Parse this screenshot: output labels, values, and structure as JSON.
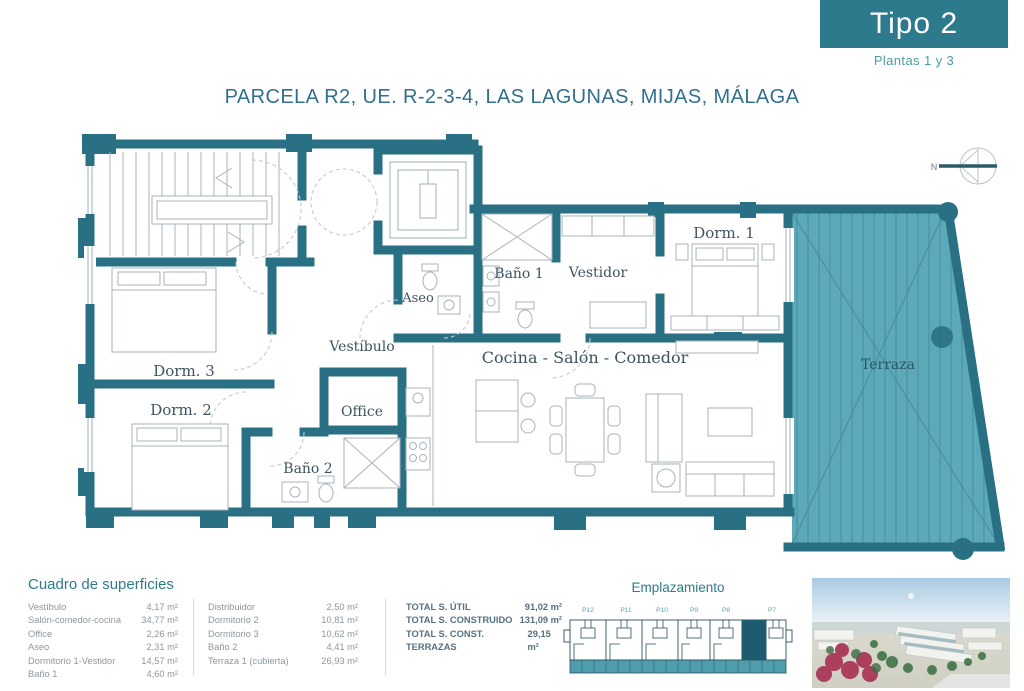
{
  "header": {
    "type_label": "Tipo 2",
    "subtitle": "Plantas 1 y 3"
  },
  "title": "PARCELA R2, UE. R-2-3-4, LAS LAGUNAS, MIJAS, MÁLAGA",
  "plan": {
    "compass": "N",
    "rooms": {
      "dorm1": "Dorm. 1",
      "vestidor": "Vestidor",
      "bano1": "Baño 1",
      "aseo": "Aseo",
      "vestibulo": "Vestíbulo",
      "salon": "Cocina - Salón - Comedor",
      "dorm3": "Dorm. 3",
      "dorm2": "Dorm. 2",
      "office": "Office",
      "bano2": "Baño 2",
      "terraza": "Terraza"
    }
  },
  "surfaces": {
    "heading": "Cuadro de superficies",
    "left": [
      {
        "label": "Vestíbulo",
        "value": "4,17 m²"
      },
      {
        "label": "Salón-comedor-cocina",
        "value": "34,77 m²"
      },
      {
        "label": "Office",
        "value": "2,26 m²"
      },
      {
        "label": "Aseo",
        "value": "2,31 m²"
      },
      {
        "label": "Dormitorio 1-Vestidor",
        "value": "14,57 m²"
      },
      {
        "label": "Baño 1",
        "value": "4,60 m²"
      }
    ],
    "right": [
      {
        "label": "Distribuidor",
        "value": "2,50 m²"
      },
      {
        "label": "Dormitorio 2",
        "value": "10,81 m²"
      },
      {
        "label": "Dormitorio 3",
        "value": "10,62 m²"
      },
      {
        "label": "Baño 2",
        "value": "4,41 m²"
      },
      {
        "label": "Terraza 1 (cubierta)",
        "value": "26,93 m²"
      }
    ],
    "totals": [
      {
        "label": "TOTAL S. ÚTIL",
        "value": "91,02 m²"
      },
      {
        "label": "TOTAL S. CONSTRUIDO",
        "value": "131,09 m²"
      },
      {
        "label": "TOTAL S. CONST. TERRAZAS",
        "value": "29,15 m²"
      }
    ]
  },
  "emplazamiento": {
    "heading": "Emplazamiento",
    "portals": [
      "P12",
      "P11",
      "P10",
      "P9",
      "P8",
      "P7"
    ],
    "highlighted_portal": "P7"
  },
  "colors": {
    "accent": "#2d7a8c",
    "wall": "#2a7085",
    "terrace": "#5caab9",
    "highlight": "#1e5b6f"
  }
}
